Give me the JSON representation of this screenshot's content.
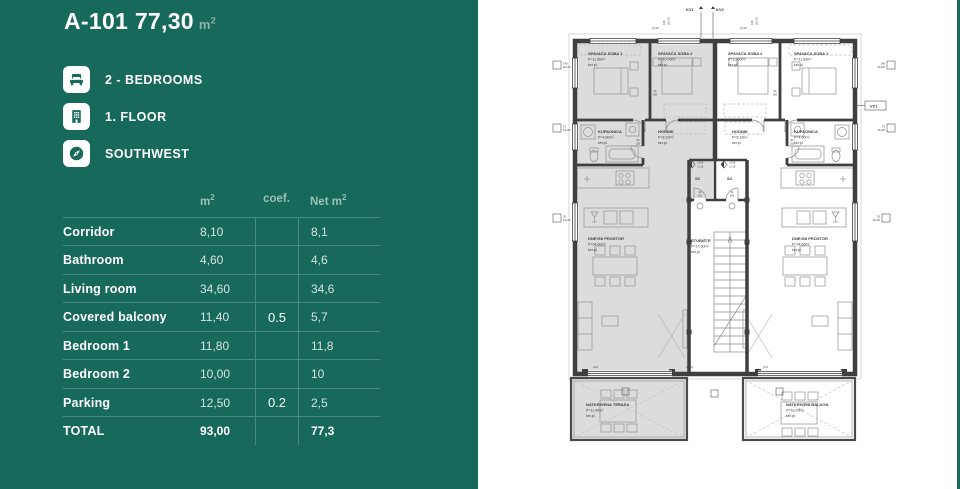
{
  "panel": {
    "title": "A-101 77,30",
    "title_unit": "m",
    "title_unit_sup": "2",
    "features": [
      {
        "icon": "bed-icon",
        "label": "2 - BEDROOMS"
      },
      {
        "icon": "building-icon",
        "label": "1. FLOOR"
      },
      {
        "icon": "compass-icon",
        "label": "SOUTHWEST"
      }
    ],
    "table": {
      "headers": {
        "m2": "m",
        "m2_sup": "2",
        "coef": "coef.",
        "net": "Net m",
        "net_sup": "2"
      },
      "rows": [
        {
          "label": "Corridor",
          "m2": "8,10",
          "coef": "",
          "net": "8,1"
        },
        {
          "label": "Bathroom",
          "m2": "4,60",
          "coef": "",
          "net": "4,6"
        },
        {
          "label": "Living room",
          "m2": "34,60",
          "coef": "",
          "net": "34,6"
        },
        {
          "label": "Covered balcony",
          "m2": "11,40",
          "coef": "0.5",
          "net": "5,7"
        },
        {
          "label": "Bedroom 1",
          "m2": "11,80",
          "coef": "",
          "net": "11,8"
        },
        {
          "label": "Bedroom 2",
          "m2": "10,00",
          "coef": "",
          "net": "10"
        },
        {
          "label": "Parking",
          "m2": "12,50",
          "coef": "0.2",
          "net": "2,5"
        },
        {
          "label": "TOTAL",
          "m2": "93,00",
          "coef": "",
          "net": "77,3",
          "total": true
        }
      ]
    }
  },
  "floorplan": {
    "rooms": {
      "soba1_l": {
        "name": "SPAVAĆA SOBA 1",
        "area": "P=11.80m²",
        "finish": "ker.pl."
      },
      "soba2_l": {
        "name": "SPAVAĆA SOBA 2",
        "area": "P=10.00m²",
        "finish": "ker.pl."
      },
      "soba2_r": {
        "name": "SPAVAĆA SOBA 2",
        "area": "P=10.00m²",
        "finish": "ker.pl."
      },
      "soba1_r": {
        "name": "SPAVAĆA SOBA 1",
        "area": "P=11.80m²",
        "finish": "ker.pl."
      },
      "kupaonica_l": {
        "name": "KUPAONICA",
        "area": "P=4.60m²",
        "finish": "ker.pl."
      },
      "hodnik_l": {
        "name": "HODNIK",
        "area": "P=8.10m²",
        "finish": "ker.pl."
      },
      "hodnik_r": {
        "name": "HODNIK",
        "area": "P=8.10m²",
        "finish": "ker.pl."
      },
      "kupaonica_r": {
        "name": "KUPAONICA",
        "area": "P=4.60m²",
        "finish": "ker.pl."
      },
      "dnevni_l": {
        "name": "DNEVNI PROSTOR",
        "area": "P=34.60m²",
        "finish": "ker.pl."
      },
      "dnevni_r": {
        "name": "DNEVNI PROSTOR",
        "area": "P=34.60m²",
        "finish": "ker.pl."
      },
      "stubiste": {
        "name": "STUBIŠTE",
        "area": "P=17.60m²",
        "finish": "ker.pl."
      },
      "terasa": {
        "name": "NATKRIVENA TERASA",
        "area": "P=11.40m²",
        "finish": "ker.pl."
      },
      "balkon": {
        "name": "NATKRIVENI BALKON",
        "area": "P=10.70m²",
        "finish": "ker.pl."
      }
    },
    "tags": {
      "kv1": "KV1",
      "kv2": "KV2",
      "vz1": "VZ1",
      "s3": "S3",
      "s4": "S4",
      "level_up": "+2.90",
      "level_dn": "+2.18",
      "p10": "p=10",
      "p0": "p=0"
    },
    "dims": {
      "d140": "140",
      "d2025": "20+25",
      "d75": "75",
      "d1020": "10+20",
      "d30": "30",
      "door_w": "90",
      "door_h": "205",
      "bath_w": "80",
      "top_v": "140",
      "top_v2": "25+20"
    }
  },
  "colors": {
    "panel_green": "#17695a",
    "highlight_gray": "#dcdcdc",
    "wall": "#3f3f3f"
  }
}
